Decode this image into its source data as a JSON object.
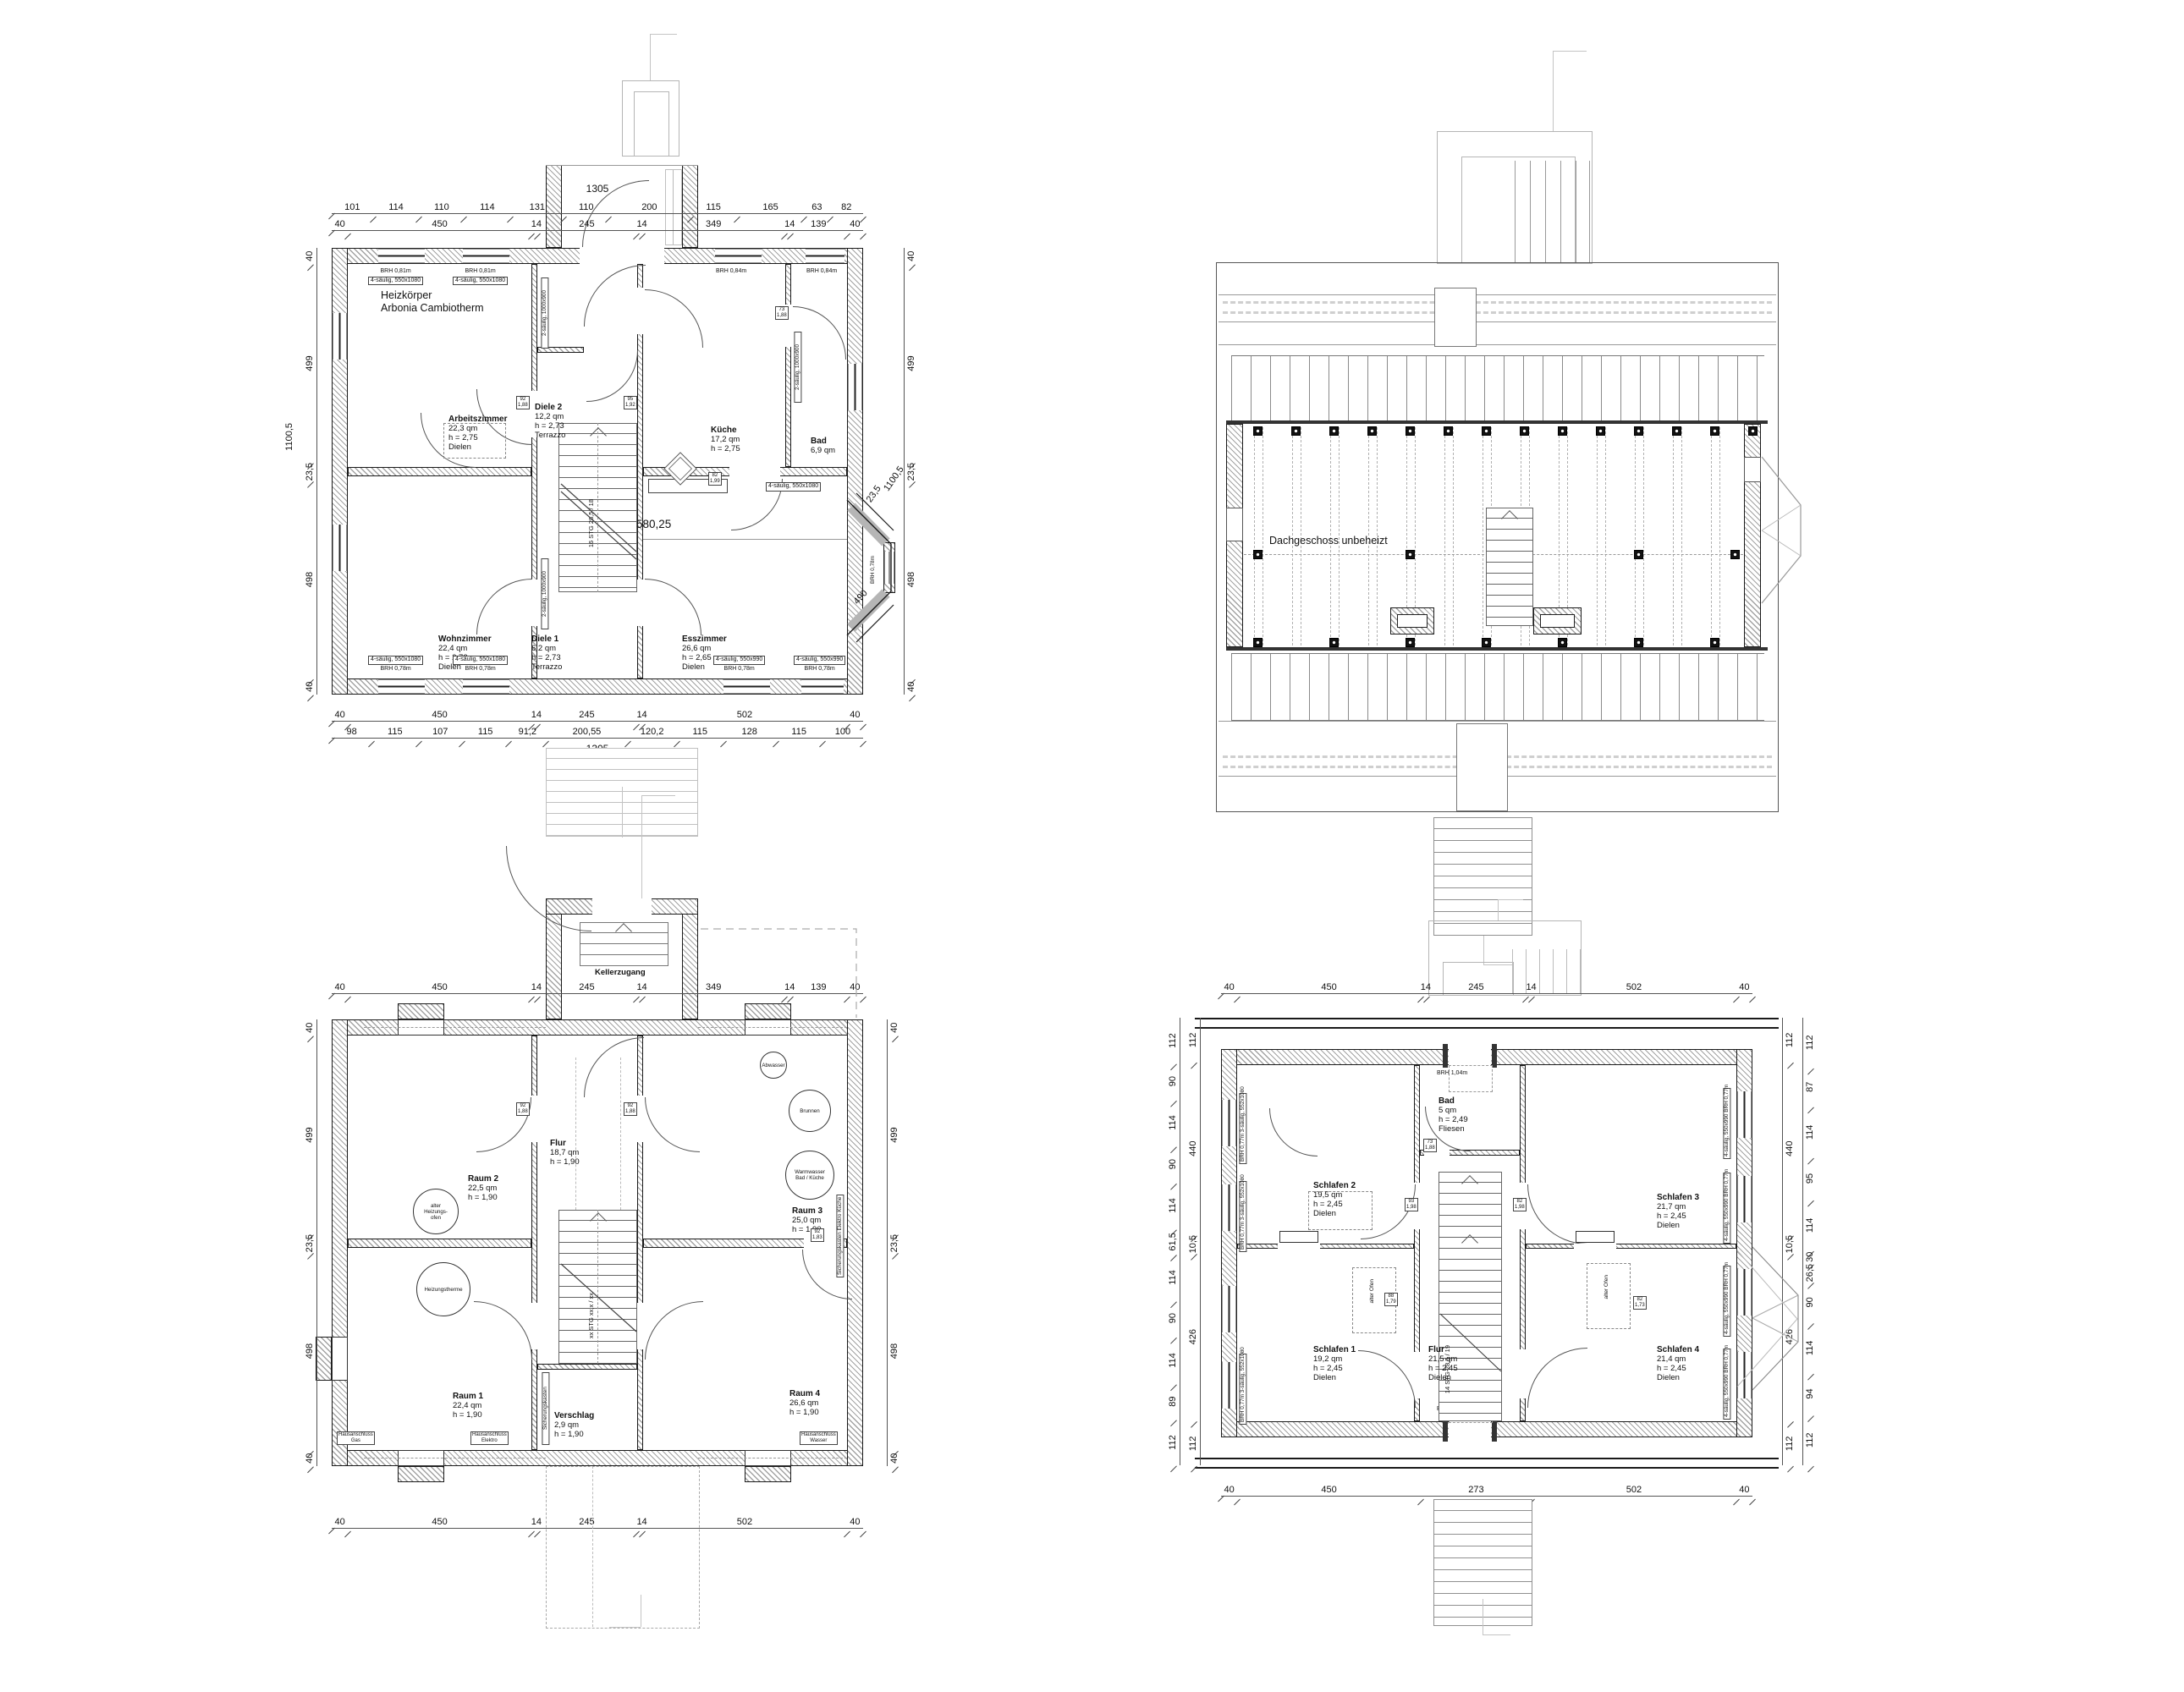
{
  "ground": {
    "note1": "Heizkörper",
    "note2": "Arbonia Cambiotherm",
    "total_top": "1305",
    "chain_top_fine": [
      "101",
      "114",
      "110",
      "114",
      "131",
      "110",
      "200",
      "115",
      "165",
      "63",
      "82"
    ],
    "chain_top_main": [
      "40",
      "450",
      "14",
      "245",
      "14",
      "349",
      "14",
      "139",
      "40"
    ],
    "chain_bottom_main": [
      "40",
      "450",
      "14",
      "245",
      "14",
      "502",
      "40"
    ],
    "chain_bottom_fine": [
      "98",
      "115",
      "107",
      "115",
      "91,2",
      "200,55",
      "120,2",
      "115",
      "128",
      "115",
      "100"
    ],
    "total_bottom": "1305",
    "chain_left": [
      "40",
      "499",
      "23,5",
      "498",
      "40"
    ],
    "total_left": "1100,5",
    "chain_right": [
      "40",
      "499",
      "23,5",
      "498",
      "40"
    ],
    "bay_dim1": "1100,5",
    "bay_dim2": "23,5",
    "bay_dim3": "490",
    "span": "580,25",
    "stair": "16 STG 28,5 / 18",
    "rooms": {
      "arbeitszimmer": {
        "name": "Arbeitszimmer",
        "area": "22,3 qm",
        "height": "h = 2,75",
        "floor": "Dielen"
      },
      "diele2": {
        "name": "Diele 2",
        "area": "12,2 qm",
        "height": "h = 2,73",
        "floor": "Terrazzo"
      },
      "kueche": {
        "name": "Küche",
        "area": "17,2 qm",
        "height": "h = 2,75"
      },
      "bad": {
        "name": "Bad",
        "area": "6,9 qm"
      },
      "wohnzimmer": {
        "name": "Wohnzimmer",
        "area": "22,4 qm",
        "height": "h = 2,72",
        "floor": "Dielen"
      },
      "diele1": {
        "name": "Diele 1",
        "area": "6,2 qm",
        "height": "h = 2,73",
        "floor": "Terrazzo"
      },
      "esszimmer": {
        "name": "Esszimmer",
        "area": "26,6 qm",
        "height": "h = 2,65",
        "floor": "Dielen"
      }
    },
    "wlabels": {
      "tl1a": "BRH 0,81m",
      "tl1b": "4-säulig, 550x1080",
      "tl2a": "BRH 0,81m",
      "tl2b": "4-säulig, 550x1080",
      "tr1": "BRH 0,84m",
      "tr2": "BRH 0,84m",
      "side1": "2-säulig, 1000x900",
      "side2": "2-säulig, 1000x900",
      "side3": "2-säulig, 1000x900",
      "kueche_side": "4-säulig, 550x1080",
      "bay": "BRH 0,78m",
      "bl1a": "4-säulig, 550x1080",
      "bl1b": "BRH 0,78m",
      "bl2a": "4-säulig, 550x1080",
      "bl2b": "BRH 0,78m",
      "br1a": "4-säulig, 550x990",
      "br1b": "BRH 0,78m",
      "br2a": "4-säulig, 550x990",
      "br2b": "BRH 0,78m"
    },
    "ddims": [
      [
        "92",
        "1,88"
      ],
      [
        "95",
        "1,92"
      ],
      [
        "82",
        "1,99"
      ],
      [
        "73",
        "1,88"
      ]
    ]
  },
  "attic": {
    "label": "Dachgeschoss unbeheizt"
  },
  "basement": {
    "entry": "Kellerzugang",
    "chain_top": [
      "40",
      "450",
      "14",
      "245",
      "14",
      "349",
      "14",
      "139",
      "40"
    ],
    "chain_bottom": [
      "40",
      "450",
      "14",
      "245",
      "14",
      "502",
      "40"
    ],
    "chain_left": [
      "40",
      "499",
      "23,5",
      "498",
      "40"
    ],
    "chain_right": [
      "40",
      "499",
      "23,5",
      "498",
      "40"
    ],
    "stair": "xx STG xx,x / xx",
    "rooms": {
      "raum2": {
        "name": "Raum 2",
        "area": "22,5 qm",
        "height": "h = 1,90"
      },
      "flur": {
        "name": "Flur",
        "area": "18,7 qm",
        "height": "h = 1,90"
      },
      "raum3": {
        "name": "Raum 3",
        "area": "25,0 qm",
        "height": "h = 1,90"
      },
      "raum1": {
        "name": "Raum 1",
        "area": "22,4 qm",
        "height": "h = 1,90"
      },
      "verschlag": {
        "name": "Verschlag",
        "area": "2,9 qm",
        "height": "h = 1,90"
      },
      "raum4": {
        "name": "Raum 4",
        "area": "26,6 qm",
        "height": "h = 1,90"
      }
    },
    "marks": {
      "ofen1": "alter",
      "ofen2": "Heizungs-",
      "ofen3": "ofen",
      "therme": "Heizungstherme",
      "brunnen": "Brunnen",
      "warm1": "Warmwasser",
      "warm2": "Bad / Küche",
      "abwasser": "Abwasser",
      "sicherung1": "Sicherungskasten",
      "sicherung2": "Elektro Küche",
      "gas1": "Hausanschluss",
      "gas2": "Gas",
      "elektro1": "Hausanschluss",
      "elektro2": "Elektro",
      "wasser1": "Hausanschluss",
      "wasser2": "Wasser"
    },
    "ddims": [
      [
        "92",
        "1,88"
      ],
      [
        "92",
        "1,88"
      ],
      [
        "92",
        "1,83"
      ]
    ]
  },
  "upper": {
    "chain_top": [
      "40",
      "450",
      "14",
      "245",
      "14",
      "502",
      "40"
    ],
    "chain_bottom": [
      "40",
      "450",
      "273",
      "502",
      "40"
    ],
    "chain_left_outer": [
      "112",
      "90",
      "114",
      "90",
      "114",
      "61,5",
      "114",
      "90",
      "114",
      "89",
      "112"
    ],
    "chain_left_inner": [
      "112",
      "440",
      "10,5",
      "426",
      "112"
    ],
    "chain_right_outer": [
      "112",
      "87",
      "114",
      "95",
      "114",
      "30",
      "26,5",
      "90",
      "114",
      "94",
      "112"
    ],
    "chain_right_inner": [
      "112",
      "440",
      "10,5",
      "426",
      "112"
    ],
    "brh_top": "BRH 1,04m",
    "brh_bottom": "BRH 1,04m",
    "stair": "14 STG 28,5 / 19",
    "alter_ofen": "alter Ofen",
    "rooms": {
      "bad": {
        "name": "Bad",
        "area": "5 qm",
        "height": "h = 2,49",
        "floor": "Fliesen"
      },
      "schlafen2": {
        "name": "Schlafen 2",
        "area": "19,5 qm",
        "height": "h = 2,45",
        "floor": "Dielen"
      },
      "schlafen3": {
        "name": "Schlafen 3",
        "area": "21,7 qm",
        "height": "h = 2,45",
        "floor": "Dielen"
      },
      "schlafen1": {
        "name": "Schlafen 1",
        "area": "19,2 qm",
        "height": "h = 2,45",
        "floor": "Dielen"
      },
      "flur": {
        "name": "Flur",
        "area": "21,5 qm",
        "height": "h = 2,45",
        "floor": "Dielen"
      },
      "schlafen4": {
        "name": "Schlafen 4",
        "area": "21,4 qm",
        "height": "h = 2,45",
        "floor": "Dielen"
      }
    },
    "wlabels": {
      "left1": "BRH 0,77m",
      "left2": "3-säulig, 552x1080",
      "right1": "4-säulig, 550x990",
      "right2": "BRH 0,77m"
    },
    "ddims": [
      [
        "73",
        "1,88"
      ],
      [
        "93",
        "1,98"
      ],
      [
        "82",
        "1,98"
      ],
      [
        "88",
        "1,79"
      ],
      [
        "82",
        "1,73"
      ]
    ]
  }
}
